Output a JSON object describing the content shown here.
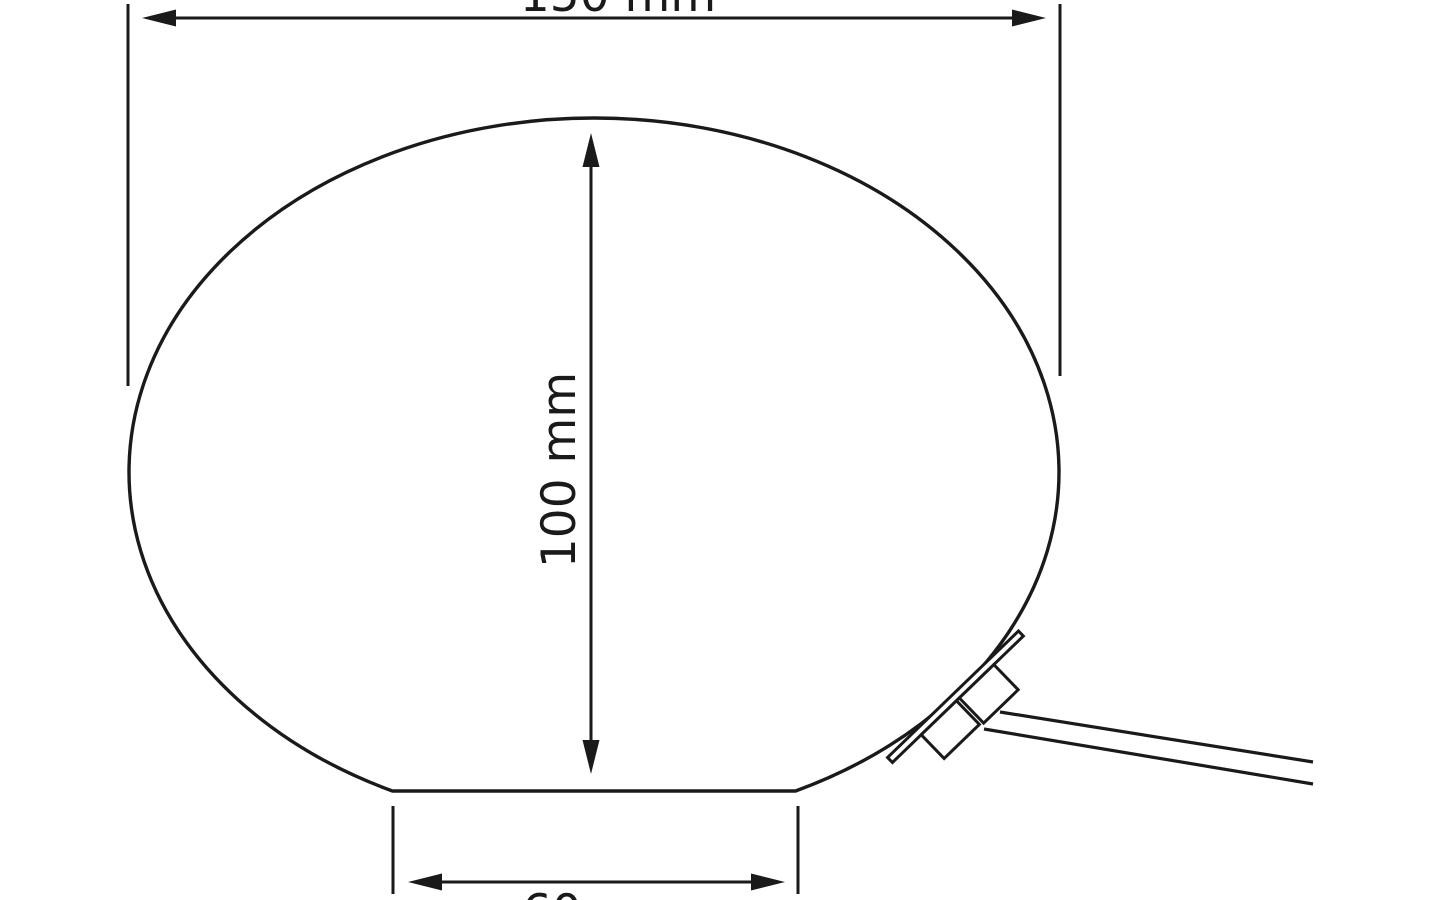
{
  "drawing": {
    "type": "dimension-diagram",
    "subject": "oval glass lamp with power cord connector",
    "labels": {
      "width": "150 mm",
      "height": "100 mm",
      "base": "60 mm"
    },
    "colors": {
      "line": "#1a1a1a",
      "background": "#ffffff"
    }
  }
}
